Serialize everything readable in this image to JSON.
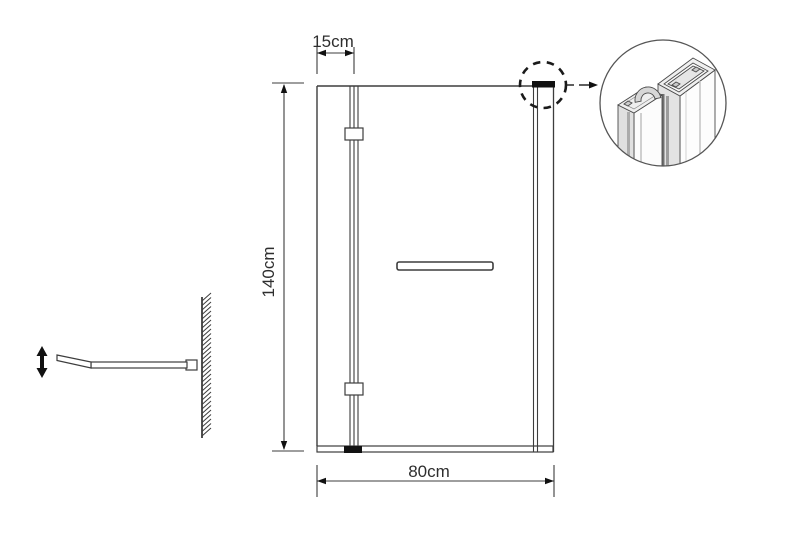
{
  "labels": {
    "panel_width": "15cm",
    "height": "140cm",
    "total_width": "80cm"
  },
  "colors": {
    "background": "#ffffff",
    "line": "#3d3d3d",
    "black_fill": "#111111"
  },
  "icons": {
    "detail_callout": "dashed-circle-callout-icon",
    "magnified_profile": "aluminium-profile-detail-icon",
    "adjustable_arm": "adjustable-arm-up-down-arrow-icon",
    "wall": "hatched-wall-icon"
  }
}
